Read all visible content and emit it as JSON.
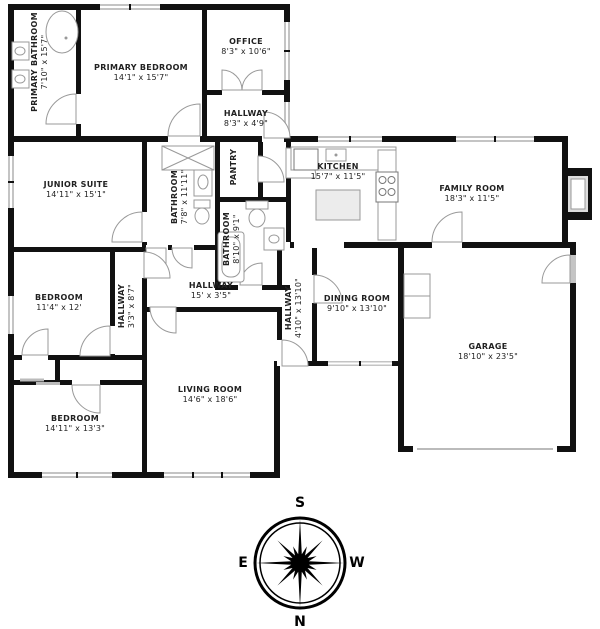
{
  "rooms": [
    {
      "name": "PRIMARY BATHROOM",
      "dims": "7'10\" x 15'7\""
    },
    {
      "name": "PRIMARY BEDROOM",
      "dims": "14'1\" x 15'7\""
    },
    {
      "name": "OFFICE",
      "dims": "8'3\" x 10'6\""
    },
    {
      "name": "HALLWAY",
      "dims": "8'3\" x 4'9\""
    },
    {
      "name": "JUNIOR SUITE",
      "dims": "14'11\" x 15'1\""
    },
    {
      "name": "BATHROOM",
      "dims": "7'8\" x 11'11\""
    },
    {
      "name": "PANTRY",
      "dims": ""
    },
    {
      "name": "KITCHEN",
      "dims": "15'7\" x 11'5\""
    },
    {
      "name": "FAMILY ROOM",
      "dims": "18'3\" x 11'5\""
    },
    {
      "name": "BATHROOM",
      "dims": "8'10\" x 9'1\""
    },
    {
      "name": "BEDROOM",
      "dims": "11'4\" x 12'"
    },
    {
      "name": "HALLWAY",
      "dims": "3'3\" x 8'7\""
    },
    {
      "name": "HALLWAY",
      "dims": "15' x 3'5\""
    },
    {
      "name": "HALLWAY",
      "dims": "4'10\" x 13'10\""
    },
    {
      "name": "DINING ROOM",
      "dims": "9'10\" x 13'10\""
    },
    {
      "name": "GARAGE",
      "dims": "18'10\" x 23'5\""
    },
    {
      "name": "BEDROOM",
      "dims": "14'11\" x 13'3\""
    },
    {
      "name": "LIVING ROOM",
      "dims": "14'6\" x 18'6\""
    }
  ],
  "compass": {
    "top": "S",
    "bottom": "N",
    "left": "E",
    "right": "W"
  },
  "colors": {
    "wall": "#111111",
    "window": "#c4c4c4",
    "fixture_line": "#999999",
    "label": "#222222"
  }
}
